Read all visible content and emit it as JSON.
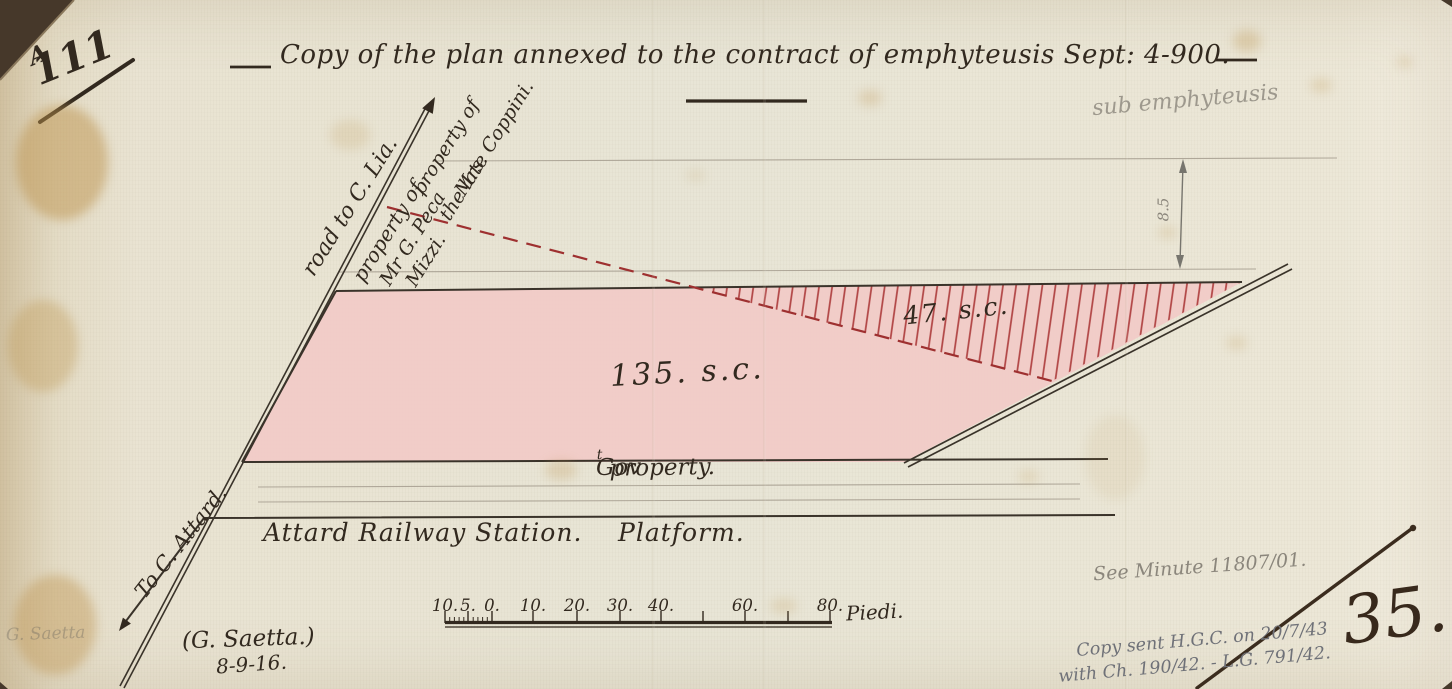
{
  "page": {
    "file_number": "111",
    "file_number_suffix": "A",
    "title": "Copy of the plan annexed to the contract of emphyteusis Sept: 4-900.",
    "sheet_number": "35."
  },
  "pencil_notes": {
    "sub_emphyteusis": "sub emphyteusis",
    "minute": "See Minute 11807/01.",
    "copy_line1": "Copy sent H.G.C. on 20/7/43",
    "copy_line2": "with Ch. 190/42. - L.G. 791/42.",
    "ghost_signature": "G. Saetta"
  },
  "plan": {
    "road_label": "road to C. Lia.",
    "peca_property": {
      "line1": "property of",
      "line2": "Mr G. Peca",
      "line3": "Mizzi."
    },
    "coppini_property": {
      "line1": "property of",
      "line2": "the late",
      "line3": "Mrs. Coppini."
    },
    "area_main": "135. s.c.",
    "area_hatched": "47. s.c.",
    "width_dimension": "8.5",
    "govt_property_prefix": "Gov",
    "govt_property_sup": "t",
    "govt_property_rest": "property.",
    "station": "Attard Railway Station.",
    "platform": "Platform.",
    "to_attard": "To C. Attard.",
    "surveyor": "(G. Saetta.)",
    "survey_date": "8-9-16."
  },
  "scale_bar": {
    "left_labels": [
      "10.",
      "5.",
      "0."
    ],
    "right_labels": [
      "10.",
      "20.",
      "30.",
      "40.",
      "60.",
      "80."
    ],
    "unit": "Piedi."
  },
  "colors": {
    "paper": "#e9e4d3",
    "ink": "#32291f",
    "red_boundary": "#9e3030",
    "hatch_red": "#b04343",
    "pink_area": "#f2cac7",
    "pencil": "#8b867c",
    "blue_pencil": "#6f7178"
  }
}
